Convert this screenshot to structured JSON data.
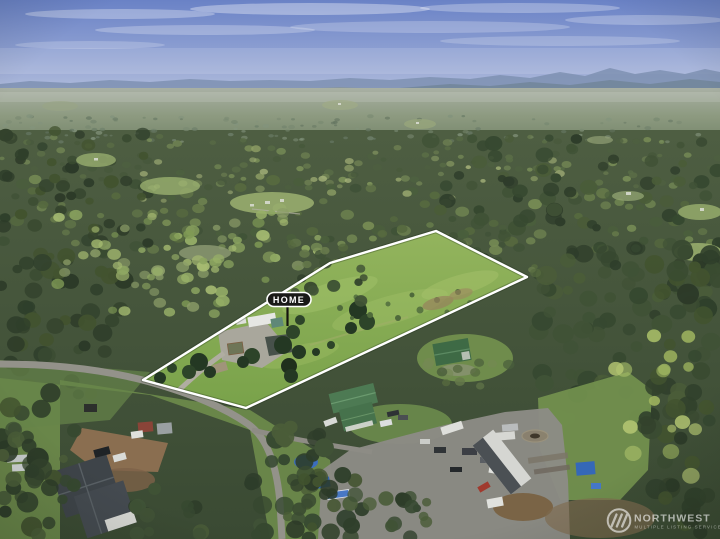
{
  "scene": {
    "type": "aerial-drone-photograph",
    "subject": "wooded rural acreage with outlined property lot, surrounding forest, country road, neighboring homes, distant hazy mountains and blue sky"
  },
  "annotations": {
    "home_label": "HOME",
    "label_bg": "#191917",
    "label_border": "#ffffff",
    "boundary_color": "#ffffff",
    "boundary_points": [
      [
        143,
        380
      ],
      [
        330,
        263
      ],
      [
        436,
        231
      ],
      [
        527,
        277
      ],
      [
        246,
        408
      ]
    ],
    "pointer_from": [
      287.5,
      306.5
    ],
    "pointer_to": [
      287.5,
      326
    ]
  },
  "watermark": {
    "brand": "NORTHWEST",
    "tagline": "MULTIPLE LISTING SERVICE",
    "icon": "nwmls-circle-slashes-icon",
    "color": "#ffffff"
  },
  "palette": {
    "sky_top": "#6a82c6",
    "sky_horizon": "#b3bedc",
    "mountains": "#7e90b2",
    "forest_dark": "#33422c",
    "forest_light": "#8ca560",
    "meadow": "#8ab153",
    "road": "#93928a",
    "barn_roof": "#3e6a45",
    "house_roof_green": "#4d7a53"
  }
}
